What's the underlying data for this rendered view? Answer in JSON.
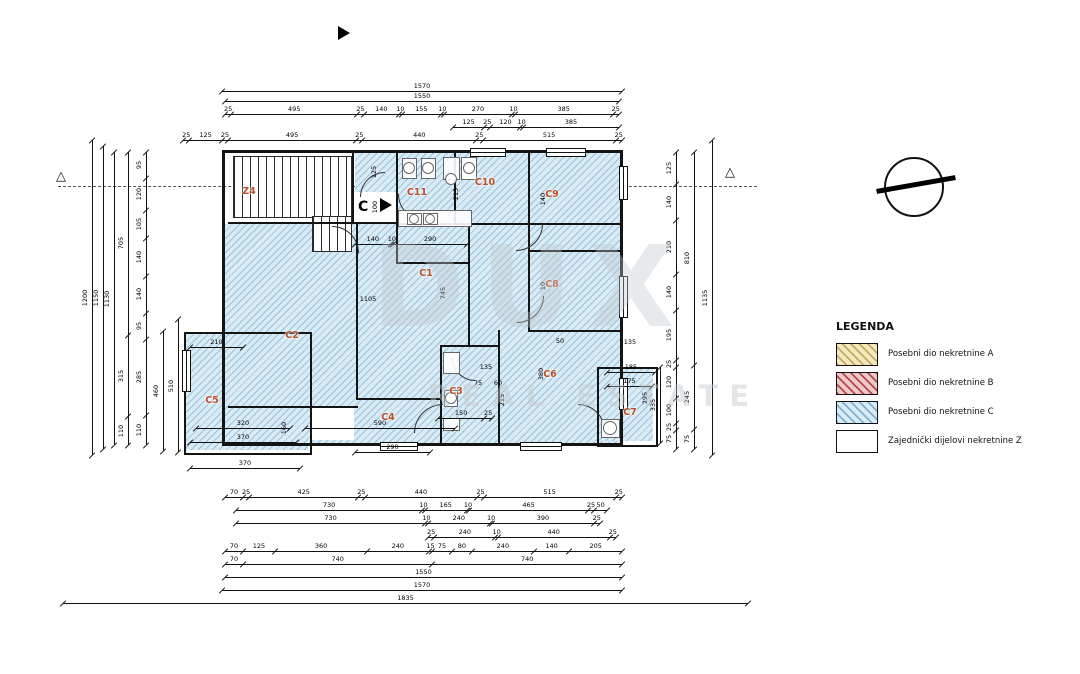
{
  "legend": {
    "title": "LEGENDA",
    "items": [
      {
        "label": "Posebni dio nekretnine A",
        "fill": "#f3e9c0",
        "hatch": "#c7a95c"
      },
      {
        "label": "Posebni dio nekretnine B",
        "fill": "#efc9c9",
        "hatch": "#b34848"
      },
      {
        "label": "Posebni dio nekretnine C",
        "fill": "#d9ebf5",
        "hatch": "#7fb0cf"
      },
      {
        "label": "Zajednički dijelovi nekretnine Z",
        "fill": "#ffffff",
        "hatch": null
      }
    ]
  },
  "watermark": {
    "line1": "DUX",
    "line2": "REAL ESTATE"
  },
  "section_marker": "C",
  "rooms": [
    {
      "id": "Z4",
      "x": 246,
      "y": 192
    },
    {
      "id": "C11",
      "x": 414,
      "y": 193
    },
    {
      "id": "C10",
      "x": 482,
      "y": 183
    },
    {
      "id": "C9",
      "x": 549,
      "y": 195
    },
    {
      "id": "C1",
      "x": 423,
      "y": 274
    },
    {
      "id": "C8",
      "x": 549,
      "y": 285
    },
    {
      "id": "C2",
      "x": 289,
      "y": 336
    },
    {
      "id": "C5",
      "x": 209,
      "y": 401
    },
    {
      "id": "C4",
      "x": 385,
      "y": 418
    },
    {
      "id": "C3",
      "x": 453,
      "y": 392
    },
    {
      "id": "C6",
      "x": 547,
      "y": 375
    },
    {
      "id": "C7",
      "x": 627,
      "y": 413
    }
  ],
  "dim_chains": [
    {
      "o": "h",
      "y": 91,
      "a": 222,
      "b": 622,
      "s": [
        "1570"
      ]
    },
    {
      "o": "h",
      "y": 101,
      "a": 225,
      "b": 619,
      "s": [
        "1550"
      ]
    },
    {
      "o": "h",
      "y": 114,
      "a": 225,
      "b": 619,
      "s": [
        "25",
        "495",
        "25",
        "140",
        "10",
        "155",
        "10",
        "270",
        "10",
        "385",
        "25"
      ]
    },
    {
      "o": "h",
      "y": 127,
      "a": 453,
      "b": 619,
      "s": [
        "125",
        "25",
        "120",
        "10",
        "385"
      ]
    },
    {
      "o": "h",
      "y": 140,
      "a": 183,
      "b": 622,
      "s": [
        "25",
        "125",
        "25",
        "495",
        "25",
        "440",
        "25",
        "515",
        "25"
      ]
    },
    {
      "o": "h",
      "y": 497,
      "a": 225,
      "b": 622,
      "s": [
        "70",
        "25",
        "425",
        "25",
        "440",
        "25",
        "515",
        "25"
      ]
    },
    {
      "o": "h",
      "y": 510,
      "a": 236,
      "b": 607,
      "s": [
        "730",
        "10",
        "165",
        "10",
        "465",
        "25",
        "50"
      ]
    },
    {
      "o": "h",
      "y": 523,
      "a": 236,
      "b": 600,
      "s": [
        "730",
        "10",
        "240",
        "10",
        "390",
        "25"
      ]
    },
    {
      "o": "h",
      "y": 537,
      "a": 428,
      "b": 616,
      "s": [
        "25",
        "240",
        "10",
        "440",
        "25"
      ]
    },
    {
      "o": "h",
      "y": 551,
      "a": 225,
      "b": 622,
      "s": [
        "70",
        "125",
        "360",
        "240",
        "15",
        "75",
        "80",
        "240",
        "140",
        "205"
      ]
    },
    {
      "o": "h",
      "y": 564,
      "a": 225,
      "b": 622,
      "s": [
        "70",
        "740",
        "740"
      ]
    },
    {
      "o": "h",
      "y": 577,
      "a": 225,
      "b": 622,
      "s": [
        "1550"
      ]
    },
    {
      "o": "h",
      "y": 590,
      "a": 222,
      "b": 622,
      "s": [
        "1570"
      ]
    },
    {
      "o": "h",
      "y": 603,
      "a": 63,
      "b": 748,
      "s": [
        "1835"
      ]
    },
    {
      "o": "v",
      "x": 92,
      "a": 140,
      "b": 455,
      "s": [
        "1200"
      ]
    },
    {
      "o": "v",
      "x": 103,
      "a": 146,
      "b": 449,
      "s": [
        "1150"
      ]
    },
    {
      "o": "v",
      "x": 114,
      "a": 152,
      "b": 445,
      "s": [
        "1130"
      ]
    },
    {
      "o": "v",
      "x": 128,
      "a": 152,
      "b": 445,
      "s": [
        "705",
        "315",
        "110"
      ]
    },
    {
      "o": "v",
      "x": 146,
      "a": 152,
      "b": 445,
      "s": [
        "95",
        "120",
        "105",
        "140",
        "140",
        "95",
        "285",
        "110"
      ]
    },
    {
      "o": "v",
      "x": 163,
      "a": 331,
      "b": 451,
      "s": [
        "460"
      ]
    },
    {
      "o": "v",
      "x": 178,
      "a": 319,
      "b": 452,
      "s": [
        "510"
      ]
    },
    {
      "o": "v",
      "x": 676,
      "a": 152,
      "b": 449,
      "s": [
        "125",
        "140",
        "210",
        "140",
        "195",
        "25",
        "120",
        "100",
        "25",
        "75"
      ]
    },
    {
      "o": "v",
      "x": 694,
      "a": 152,
      "b": 449,
      "s": [
        "810",
        "245",
        "75"
      ]
    },
    {
      "o": "v",
      "x": 712,
      "a": 140,
      "b": 455,
      "s": [
        "1135"
      ]
    },
    {
      "o": "v",
      "x": 660,
      "a": 367,
      "b": 443,
      "s": [
        "335"
      ]
    },
    {
      "o": "h",
      "y": 244,
      "a": 355,
      "b": 467,
      "s": [
        "140",
        "10",
        "290"
      ]
    },
    {
      "o": "h",
      "y": 347,
      "a": 190,
      "b": 243,
      "s": [
        "210"
      ]
    },
    {
      "o": "h",
      "y": 428,
      "a": 196,
      "b": 290,
      "s": [
        "320"
      ]
    },
    {
      "o": "h",
      "y": 442,
      "a": 190,
      "b": 296,
      "s": [
        "370"
      ]
    },
    {
      "o": "h",
      "y": 468,
      "a": 190,
      "b": 300,
      "s": [
        "370"
      ]
    },
    {
      "o": "h",
      "y": 428,
      "a": 305,
      "b": 455,
      "s": [
        "590"
      ]
    },
    {
      "o": "h",
      "y": 452,
      "a": 355,
      "b": 430,
      "s": [
        "290"
      ]
    },
    {
      "o": "h",
      "y": 418,
      "a": 438,
      "b": 492,
      "s": [
        "150",
        "25"
      ]
    },
    {
      "o": "h",
      "y": 372,
      "a": 607,
      "b": 655,
      "s": [
        "185"
      ]
    },
    {
      "o": "h",
      "y": 386,
      "a": 607,
      "b": 652,
      "s": [
        "175"
      ]
    }
  ],
  "texts": [
    {
      "x": 368,
      "y": 299,
      "t": "1105",
      "r": 0
    },
    {
      "x": 443,
      "y": 293,
      "t": "745",
      "r": 1
    },
    {
      "x": 543,
      "y": 199,
      "t": "140",
      "r": 1
    },
    {
      "x": 543,
      "y": 286,
      "t": "10",
      "r": 1
    },
    {
      "x": 541,
      "y": 374,
      "t": "380",
      "r": 1
    },
    {
      "x": 456,
      "y": 194,
      "t": "215",
      "r": 1
    },
    {
      "x": 374,
      "y": 172,
      "t": "125",
      "r": 1
    },
    {
      "x": 375,
      "y": 207,
      "t": "100",
      "r": 1
    },
    {
      "x": 560,
      "y": 341,
      "t": "50",
      "r": 0
    },
    {
      "x": 630,
      "y": 342,
      "t": "135",
      "r": 0
    },
    {
      "x": 486,
      "y": 367,
      "t": "135",
      "r": 0
    },
    {
      "x": 478,
      "y": 383,
      "t": "75",
      "r": 0
    },
    {
      "x": 498,
      "y": 383,
      "t": "60",
      "r": 0
    },
    {
      "x": 502,
      "y": 400,
      "t": "215",
      "r": 1
    },
    {
      "x": 645,
      "y": 398,
      "t": "295",
      "r": 1
    },
    {
      "x": 284,
      "y": 428,
      "t": "160",
      "r": 1
    }
  ]
}
